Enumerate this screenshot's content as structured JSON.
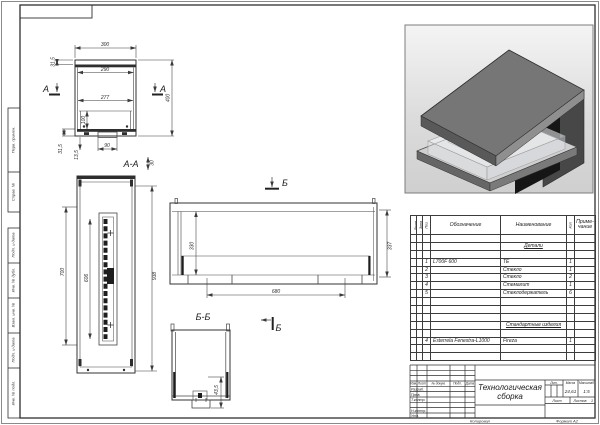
{
  "frame": {
    "copied": "Копировал",
    "format": "Формат А2"
  },
  "margins": {
    "perv": "Перв. примен.",
    "sprav": "Справ. №",
    "podp1": "Подп. и дата",
    "inv_dubl": "Инв. № дубл.",
    "vzam": "Взам. инв. №",
    "podp2": "Подп. и дата",
    "inv_podl": "Инв. № подл."
  },
  "labels": {
    "a_left": "А",
    "a_right": "А",
    "aa": "А-А",
    "b_top": "Б",
    "b_bot": "Б",
    "bb": "Б-Б"
  },
  "dims": {
    "d300": "300",
    "d315a": "31,5",
    "d290": "290",
    "d277": "277",
    "d100": "100",
    "d90": "90",
    "d135": "13,5",
    "d315b": "31,5",
    "d400": "400",
    "d30": "30",
    "d700": "700",
    "d606": "606",
    "d938": "938",
    "d330": "330",
    "d337": "337",
    "d680": "680",
    "d435": "43,5"
  },
  "spec": {
    "hdr": {
      "form": "Форм.",
      "zone": "Зона",
      "pos": "Поз.",
      "design": "Обозначение",
      "name": "Наименование",
      "qty": "Кол.",
      "note1": "Приме-",
      "note2": "чание"
    },
    "sec1": "Детали",
    "rows": [
      {
        "pos": "1",
        "design": "L700F 600",
        "name": "ТЕ",
        "qty": "1"
      },
      {
        "pos": "2",
        "design": "",
        "name": "Стекло",
        "qty": "1"
      },
      {
        "pos": "3",
        "design": "",
        "name": "Стекло",
        "qty": "2"
      },
      {
        "pos": "4",
        "design": "",
        "name": "Стемалит",
        "qty": "1"
      },
      {
        "pos": "5",
        "design": "",
        "name": "Стеклодержатель",
        "qty": "6"
      }
    ],
    "sec2": "Стандартные изделия",
    "rows2": [
      {
        "pos": "4",
        "design": "Esterrela Fenestra-L1000",
        "name": "Fireza",
        "qty": "1"
      }
    ]
  },
  "tb": {
    "title": "Технологическая сборка",
    "cols": {
      "izm": "Изм.",
      "list": "Лист",
      "docnum": "№ докум.",
      "podp": "Подп.",
      "data": "Дата"
    },
    "rows": {
      "razrab": "Разраб.",
      "prov": "Пров.",
      "tkontr": "Т.контр.",
      "nkontr": "Н.контр.",
      "utv": "Утв."
    },
    "lit": "Лит.",
    "mass": "Масса",
    "scale": "Масштаб",
    "mass_v": "24,61",
    "scale_v": "1:5",
    "list_l": "Лист",
    "listov_l": "Листов",
    "listov_v": "1"
  }
}
